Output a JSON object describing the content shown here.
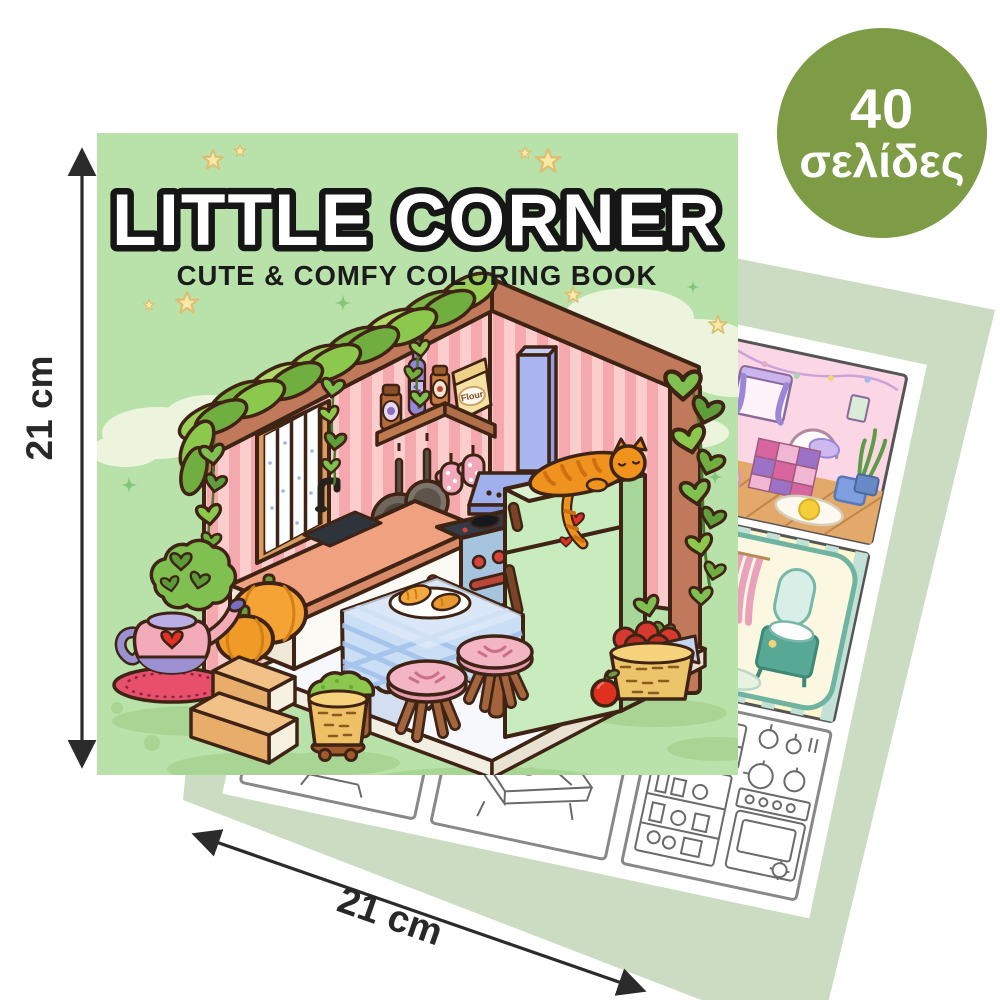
{
  "page": {
    "background_color": "#ffffff"
  },
  "badge": {
    "pages_count": "40",
    "pages_unit": "σελίδες",
    "background_color": "#7e9b45",
    "text_color": "#ffffff"
  },
  "dimensions": {
    "height_label": "21 cm",
    "width_label": "21 cm",
    "arrow_color": "#2b2b2b"
  },
  "book_cover": {
    "title": "LITTLE CORNER",
    "subtitle": "CUTE & COMFY COLORING BOOK",
    "flour_bag_label": "Flour",
    "background_color": "#b9e2ab",
    "title_fill": "#ffffff",
    "title_outline": "#161616",
    "outline_color": "#3f2415",
    "scene": "isometric cozy kitchen corner illustration",
    "scene_elements": [
      "vine garland",
      "hanging heart leaves",
      "clouds",
      "stars",
      "sparkles",
      "pink striped walls",
      "wood beams",
      "window with lace curtains",
      "corner shelf",
      "jam jars",
      "wine bottle",
      "flour bag",
      "hanging pans",
      "oven mitts",
      "range hood",
      "sink counter",
      "faucet",
      "stove with red knobs",
      "mint green fridge",
      "sleeping orange cat",
      "red heart magnets",
      "dining table with blue checkered cloth",
      "plate with croissants",
      "pink stools",
      "pumpkins",
      "teapot planter with heart",
      "doily rug",
      "wooden steps",
      "moss basket",
      "apple basket",
      "red apple",
      "checkered floor platform",
      "grass shadows"
    ]
  },
  "back_pages": {
    "sheet_color": "#cbdcc2",
    "page_color": "#ffffff",
    "samples": [
      {
        "name": "bedroom-sample",
        "style": "colored"
      },
      {
        "name": "bathroom-sample",
        "style": "colored"
      },
      {
        "name": "kitchen-lineart-sample",
        "style": "line-art"
      },
      {
        "name": "lineart-sample-middle",
        "style": "line-art"
      },
      {
        "name": "lineart-sample-left",
        "style": "line-art"
      }
    ]
  },
  "palette": {
    "wall_pink": "#f5a9ae",
    "wall_pink_light": "#fbcdcd",
    "fridge_mint": "#c9ecbf",
    "hood_periwinkle": "#a9b6ef",
    "counter_salmon": "#f0a180",
    "cloth_blue": "#cadef6",
    "stool_pink": "#f3b5c3",
    "pumpkin_orange": "#f6a336",
    "vine_green": "#7fc051",
    "grass_shadow": "#a9d594"
  }
}
